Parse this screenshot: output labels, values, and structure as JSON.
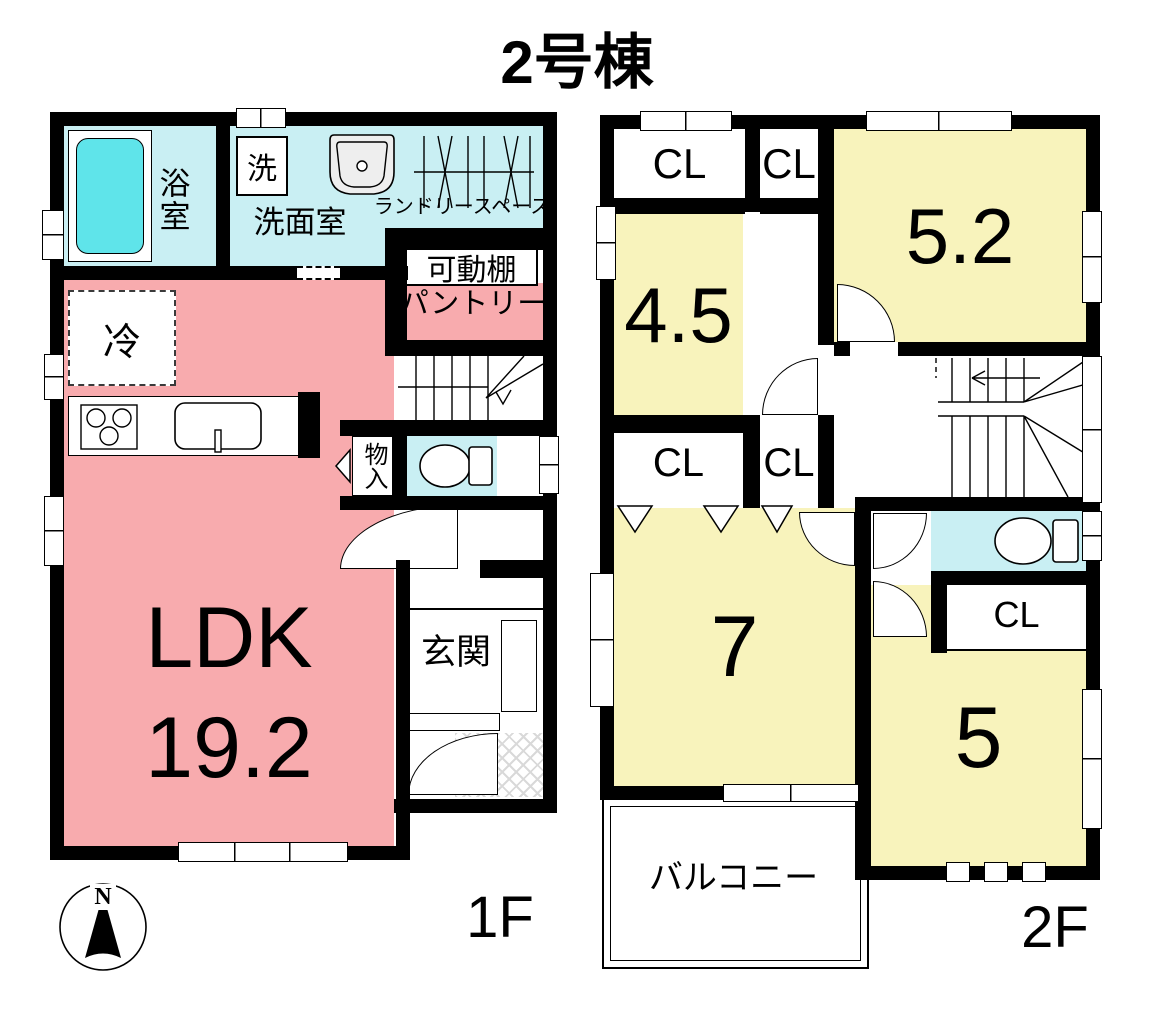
{
  "title": "2号棟",
  "colors": {
    "wall": "#000000",
    "room_pink": "#F8ABAE",
    "room_yellow": "#F8F3BC",
    "room_cyan": "#C9EFF3",
    "tub_cyan": "#5FE4EA",
    "hatch_gray": "#D9D9D9"
  },
  "floor1": {
    "label": "1F",
    "bath": "浴室",
    "washer": "洗",
    "washroom": "洗面室",
    "laundry_space": "ランドリースペース",
    "movable_shelf": "可動棚",
    "pantry": "パントリー",
    "fridge": "冷",
    "ldk_name": "LDK",
    "ldk_size": "19.2",
    "storage": "物入",
    "entrance": "玄関"
  },
  "floor2": {
    "label": "2F",
    "closet_a": "CL",
    "closet_b": "CL",
    "closet_c": "CL",
    "closet_d": "CL",
    "closet_e": "CL",
    "room_45": "4.5",
    "room_52": "5.2",
    "room_7": "7",
    "room_5": "5",
    "balcony": "バルコニー"
  },
  "compass": {
    "north": "N"
  }
}
